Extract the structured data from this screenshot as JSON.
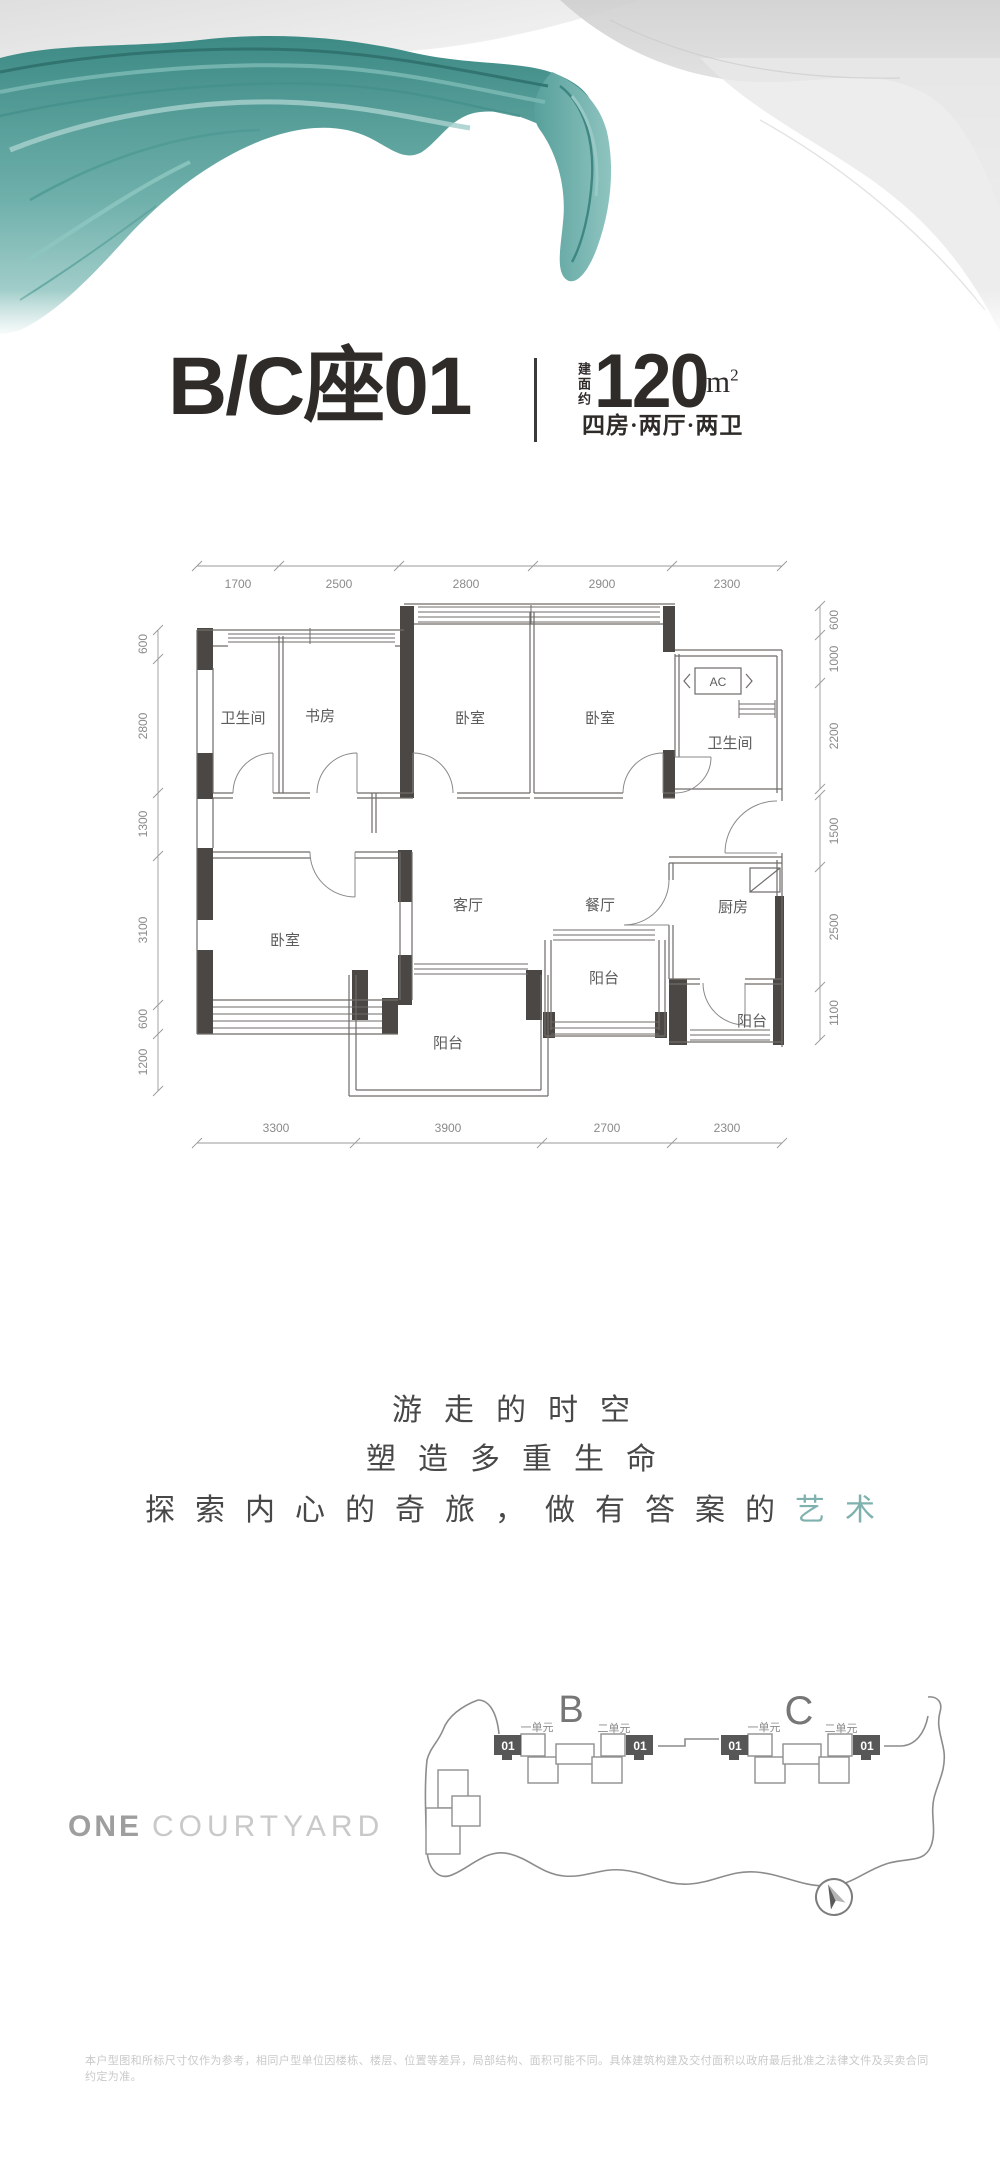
{
  "header": {
    "unit_title": "B/C座01",
    "area_prefix": "建面约",
    "area_value": "120",
    "area_unit": "m",
    "area_sup": "2",
    "layout_label": "四房·两厅·两卫"
  },
  "floorplan": {
    "rooms": [
      "卫生间",
      "书房",
      "卧室",
      "卧室",
      "卫生间",
      "卧室",
      "客厅",
      "餐厅",
      "厨房",
      "阳台",
      "阳台",
      "阳台"
    ],
    "ac_label": "AC",
    "dims_top": [
      "1700",
      "2500",
      "2800",
      "2900",
      "2300"
    ],
    "dims_bottom": [
      "3300",
      "3900",
      "2700",
      "2300"
    ],
    "dims_left": [
      "600",
      "2800",
      "1300",
      "3100",
      "600",
      "1200"
    ],
    "dims_right": [
      "600",
      "1000",
      "2200",
      "1500",
      "2500",
      "1100"
    ]
  },
  "slogan": {
    "line1": "游走的时空",
    "line2": "塑造多重生命",
    "line3_prefix": "探索内心的奇旅，做有答案的",
    "line3_accent": "艺术"
  },
  "logo": {
    "part1": "ONE",
    "part2": "COURTYARD"
  },
  "siteplan": {
    "building_b": "B",
    "building_c": "C",
    "unit1": "一单元",
    "unit2": "二单元",
    "badge": "01"
  },
  "disclaimer": {
    "text": "本户型图和所标尺寸仅作为参考，相同户型单位因楼栋、楼层、位置等差异，局部结构、面积可能不同。具体建筑构建及交付面积以政府最后批准之法律文件及买卖合同约定为准。"
  },
  "colors": {
    "ink": "#2f2b29",
    "wall": "#6f6b68",
    "column": "#4b4744",
    "dim_text": "#8a8a8a",
    "accent_teal": "#7fb2ae",
    "site_gray": "#8c8c8c",
    "badge_bg": "#575757"
  }
}
